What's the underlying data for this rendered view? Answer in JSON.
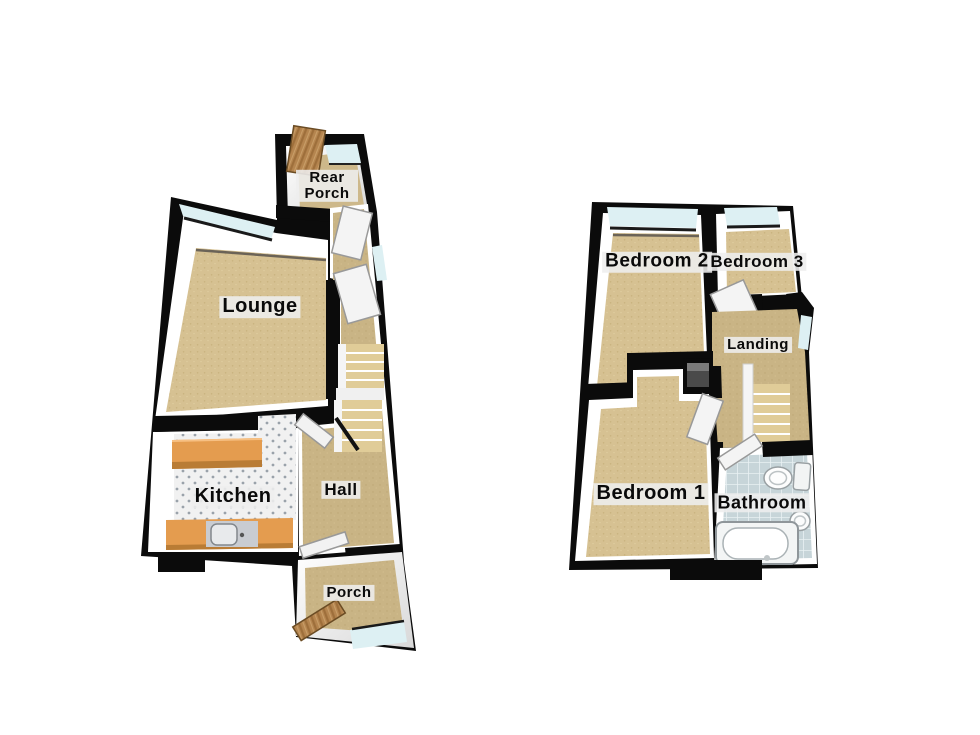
{
  "title": "3D floorplan - two storeys",
  "colors": {
    "wall_black": "#0b0b0b",
    "wall_face_white": "#ffffff",
    "carpet_tan": "#d6c192",
    "carpet_dark_tan": "#c9b485",
    "window_cyan": "#ddf0f3",
    "counter_orange": "#e49c4f",
    "door_wood": "#b5854f",
    "bathroom_tile": "#c7d5d9",
    "kitchen_floor": "#f1f1f1",
    "label_background": "#eeeeee",
    "stair_beige": "#e0cc98"
  },
  "ground_floor": {
    "rooms": {
      "rear_porch": {
        "label": "Rear Porch"
      },
      "lounge": {
        "label": "Lounge"
      },
      "kitchen": {
        "label": "Kitchen"
      },
      "hall": {
        "label": "Hall"
      },
      "porch": {
        "label": "Porch"
      }
    }
  },
  "first_floor": {
    "rooms": {
      "bedroom2": {
        "label": "Bedroom 2"
      },
      "bedroom3": {
        "label": "Bedroom 3"
      },
      "landing": {
        "label": "Landing"
      },
      "bedroom1": {
        "label": "Bedroom 1"
      },
      "bathroom": {
        "label": "Bathroom"
      }
    }
  }
}
